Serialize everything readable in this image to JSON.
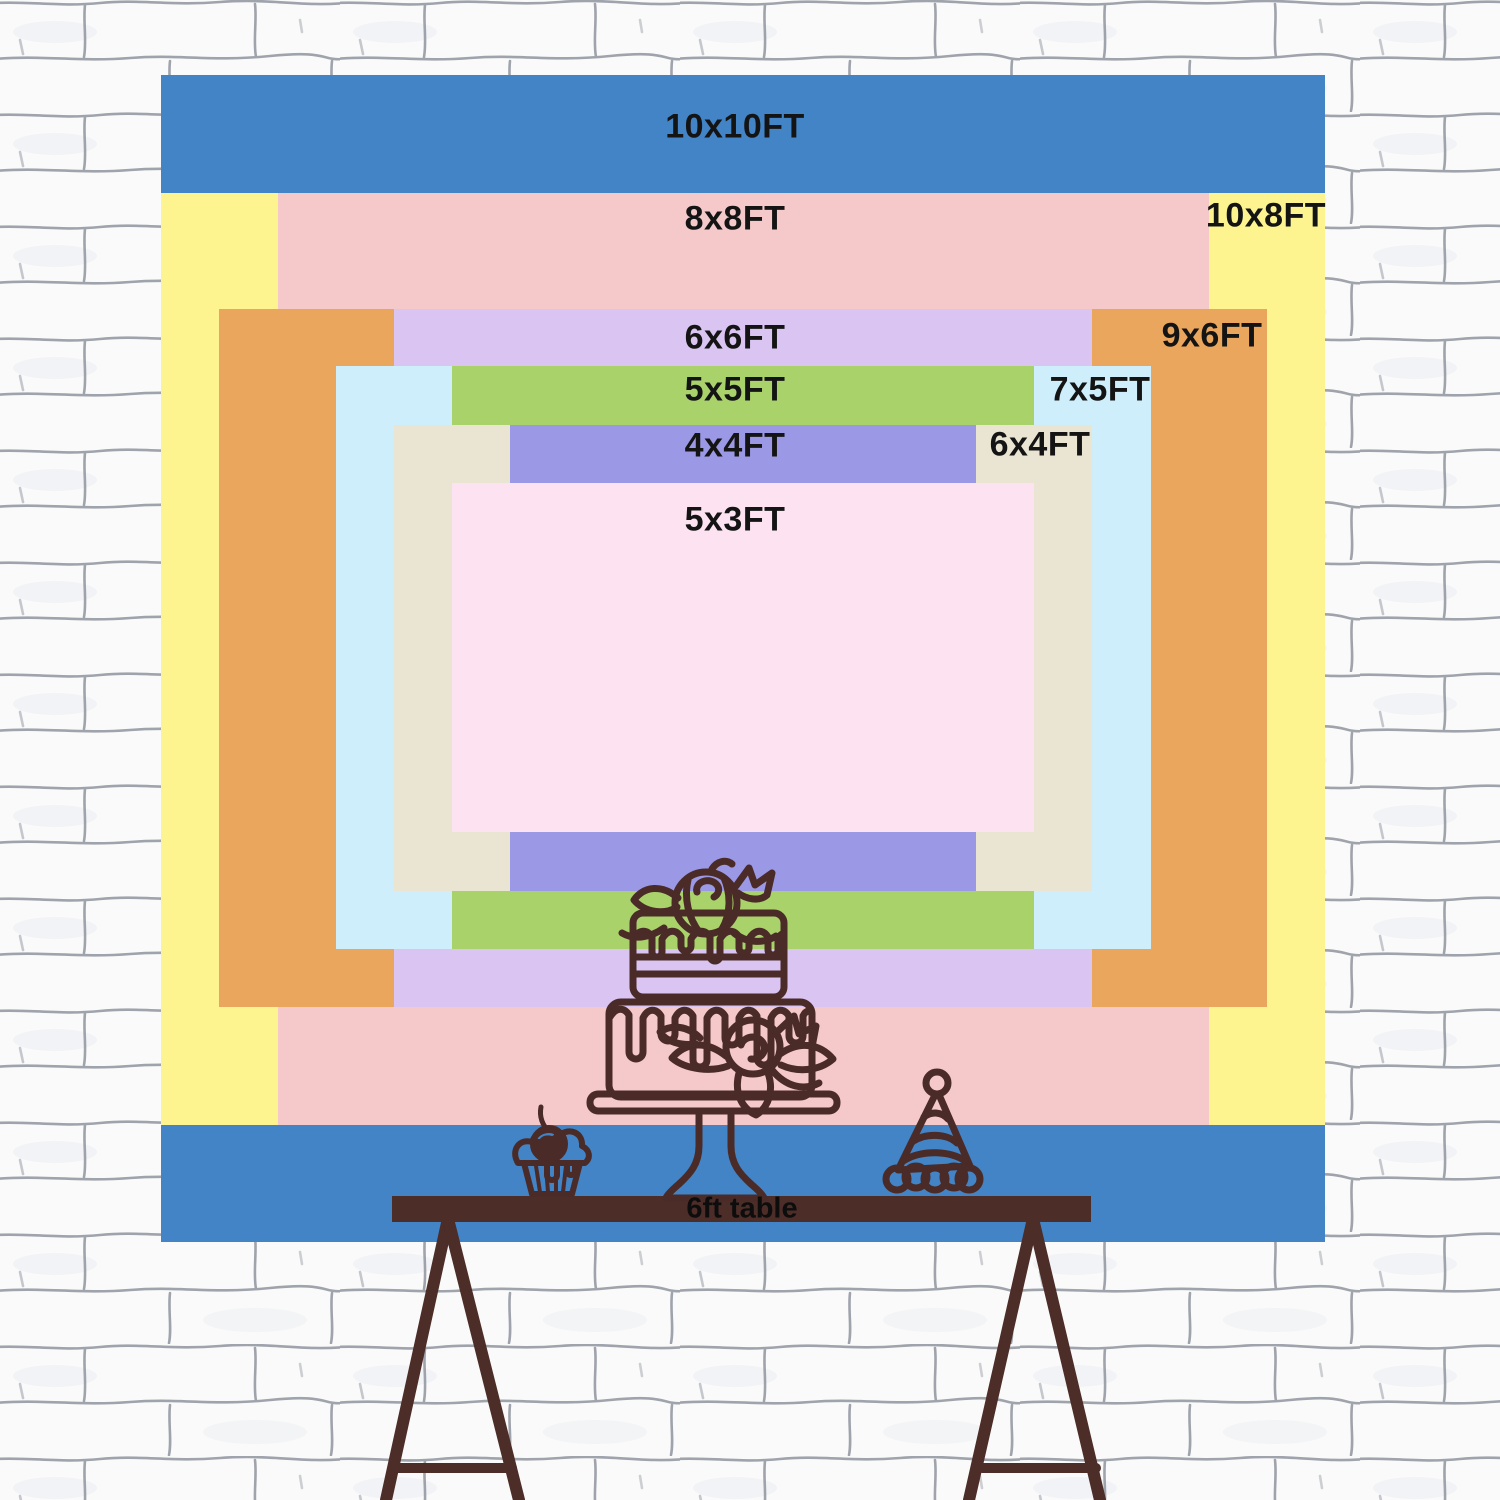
{
  "backdrop_chart": {
    "title_context": "backdrop size comparison chart",
    "layers": [
      {
        "id": "10x10",
        "label": "10x10FT",
        "color": "#4284c6"
      },
      {
        "id": "10x8",
        "label": "10x8FT",
        "color": "#fdf48f"
      },
      {
        "id": "8x8",
        "label": "8x8FT",
        "color": "#f5c9ca"
      },
      {
        "id": "9x6",
        "label": "9x6FT",
        "color": "#eaa65c"
      },
      {
        "id": "6x6",
        "label": "6x6FT",
        "color": "#d9c4f2"
      },
      {
        "id": "7x5",
        "label": "7x5FT",
        "color": "#cdeefa"
      },
      {
        "id": "5x5",
        "label": "5x5FT",
        "color": "#a9d26b"
      },
      {
        "id": "6x4",
        "label": "6x4FT",
        "color": "#eae5d3"
      },
      {
        "id": "4x4",
        "label": "4x4FT",
        "color": "#9b99e6"
      },
      {
        "id": "5x3",
        "label": "5x3FT",
        "color": "#fde3f1"
      }
    ],
    "table": {
      "label": "6ft table",
      "wood_color": "#4c2d28"
    },
    "line_art_color": "#4a2b27",
    "text_color": "#141414",
    "wall_line_color": "#8f949e"
  }
}
